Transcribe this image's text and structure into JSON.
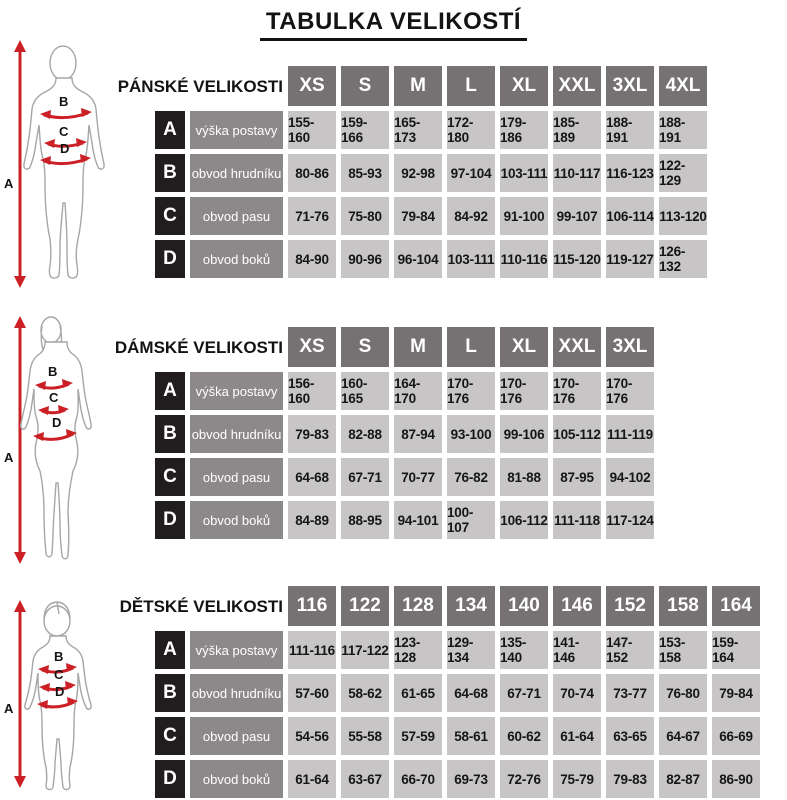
{
  "title": "TABULKA VELIKOSTÍ",
  "figure_markers": {
    "height": "A",
    "chest": "B",
    "waist": "C",
    "hips": "D"
  },
  "tables": [
    {
      "section_title": "PÁNSKÉ VELIKOSTI",
      "sizes": [
        "XS",
        "S",
        "M",
        "L",
        "XL",
        "XXL",
        "3XL",
        "4XL"
      ],
      "rows": [
        {
          "letter": "A",
          "label": "výška postavy",
          "values": [
            "155-160",
            "159-166",
            "165-173",
            "172-180",
            "179-186",
            "185-189",
            "188-191",
            "188-191"
          ]
        },
        {
          "letter": "B",
          "label": "obvod hrudníku",
          "values": [
            "80-86",
            "85-93",
            "92-98",
            "97-104",
            "103-111",
            "110-117",
            "116-123",
            "122-129"
          ]
        },
        {
          "letter": "C",
          "label": "obvod pasu",
          "values": [
            "71-76",
            "75-80",
            "79-84",
            "84-92",
            "91-100",
            "99-107",
            "106-114",
            "113-120"
          ]
        },
        {
          "letter": "D",
          "label": "obvod boků",
          "values": [
            "84-90",
            "90-96",
            "96-104",
            "103-111",
            "110-116",
            "115-120",
            "119-127",
            "126-132"
          ]
        }
      ]
    },
    {
      "section_title": "DÁMSKÉ VELIKOSTI",
      "sizes": [
        "XS",
        "S",
        "M",
        "L",
        "XL",
        "XXL",
        "3XL"
      ],
      "rows": [
        {
          "letter": "A",
          "label": "výška postavy",
          "values": [
            "156-160",
            "160-165",
            "164-170",
            "170-176",
            "170-176",
            "170-176",
            "170-176"
          ]
        },
        {
          "letter": "B",
          "label": "obvod hrudníku",
          "values": [
            "79-83",
            "82-88",
            "87-94",
            "93-100",
            "99-106",
            "105-112",
            "111-119"
          ]
        },
        {
          "letter": "C",
          "label": "obvod pasu",
          "values": [
            "64-68",
            "67-71",
            "70-77",
            "76-82",
            "81-88",
            "87-95",
            "94-102"
          ]
        },
        {
          "letter": "D",
          "label": "obvod boků",
          "values": [
            "84-89",
            "88-95",
            "94-101",
            "100-107",
            "106-112",
            "111-118",
            "117-124"
          ]
        }
      ]
    },
    {
      "section_title": "DĚTSKÉ VELIKOSTI",
      "sizes": [
        "116",
        "122",
        "128",
        "134",
        "140",
        "146",
        "152",
        "158",
        "164"
      ],
      "rows": [
        {
          "letter": "A",
          "label": "výška postavy",
          "values": [
            "111-116",
            "117-122",
            "123-128",
            "129-134",
            "135-140",
            "141-146",
            "147-152",
            "153-158",
            "159-164"
          ]
        },
        {
          "letter": "B",
          "label": "obvod hrudníku",
          "values": [
            "57-60",
            "58-62",
            "61-65",
            "64-68",
            "67-71",
            "70-74",
            "73-77",
            "76-80",
            "79-84"
          ]
        },
        {
          "letter": "C",
          "label": "obvod pasu",
          "values": [
            "54-56",
            "55-58",
            "57-59",
            "58-61",
            "60-62",
            "61-64",
            "63-65",
            "64-67",
            "66-69"
          ]
        },
        {
          "letter": "D",
          "label": "obvod boků",
          "values": [
            "61-64",
            "63-67",
            "66-70",
            "69-73",
            "72-76",
            "75-79",
            "79-83",
            "82-87",
            "86-90"
          ]
        }
      ]
    }
  ],
  "colors": {
    "size_header_bg": "#767172",
    "letter_cell_bg": "#211d1e",
    "label_cell_bg": "#8d8889",
    "value_cell_bg": "#c7c5c6",
    "arrow_red": "#cc2027",
    "figure_outline": "#a6a6a6"
  }
}
